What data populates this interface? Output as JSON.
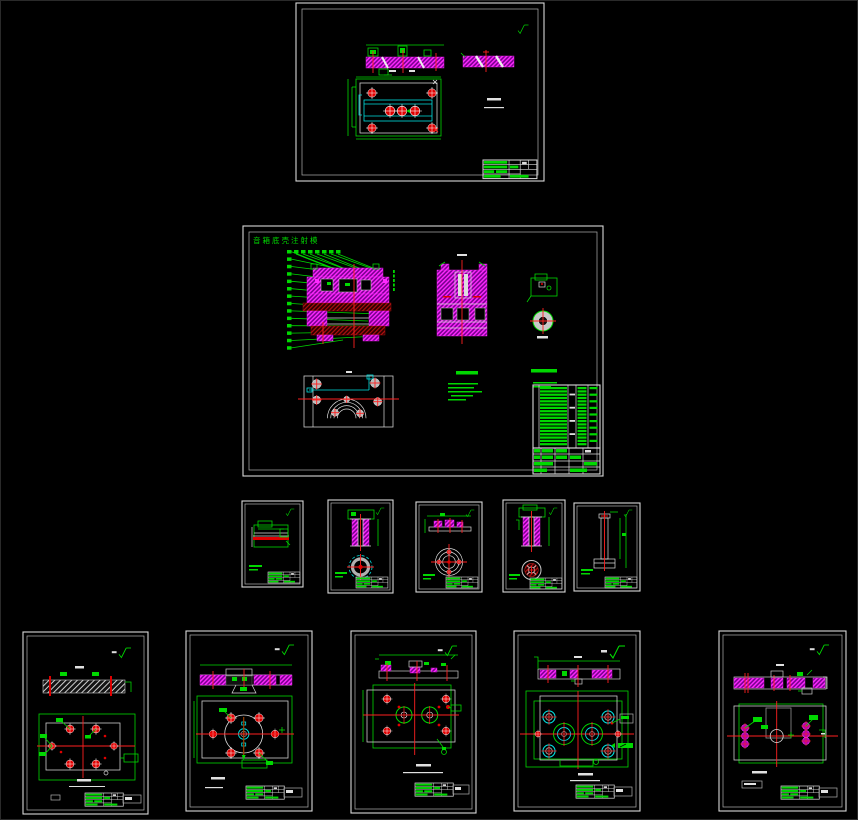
{
  "canvas": {
    "background": "#000000",
    "sheet_count": 13
  },
  "palette": {
    "green": "#00d800",
    "magenta": "#ff2aff",
    "magenta_fill": "#7a0090",
    "red": "#e00000",
    "maroon_hatch": "#b01010",
    "cyan": "#00e0e0",
    "white": "#e0e0e0",
    "sheet_border": "#d8d8d8"
  },
  "main_sheet": {
    "title": "音箱底壳注射模"
  }
}
